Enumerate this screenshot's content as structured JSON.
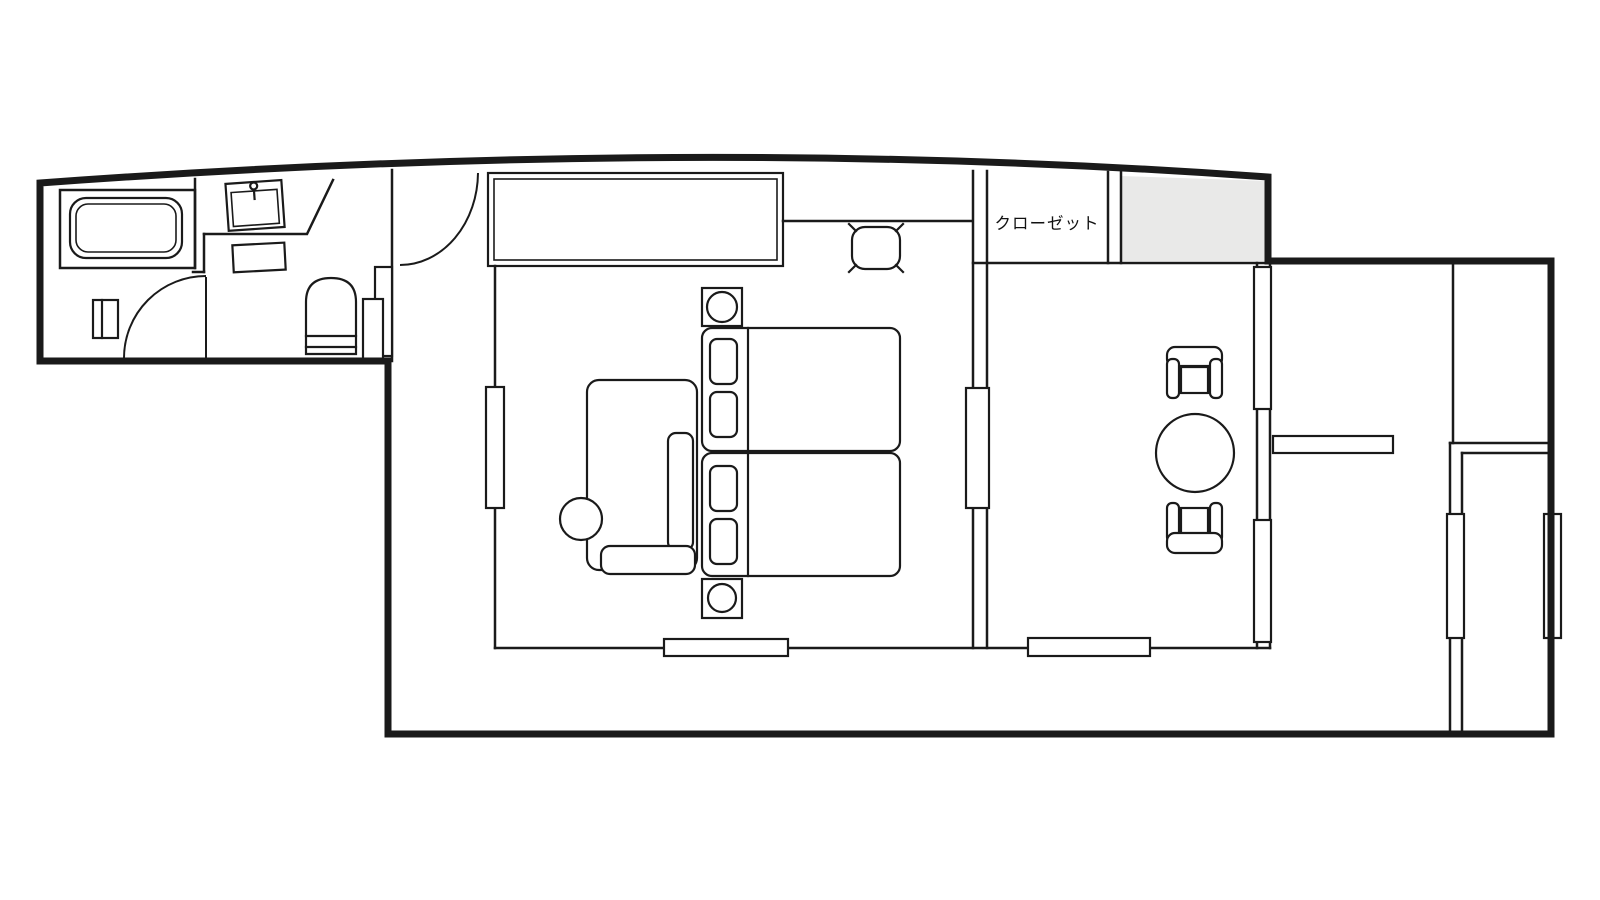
{
  "labels": {
    "closet": "クローゼット"
  },
  "colors": {
    "line": "#1a1a1a",
    "background": "#ffffff",
    "shaft_fill": "#e9e9e8"
  },
  "elements": [
    "bathtub-icon",
    "washbasin-icon",
    "vanity-shelf-icon",
    "laundry-space-icon",
    "toilet-icon",
    "washroom-swing-door-icon",
    "hall-sliding-door-icon",
    "entrance-swing-door-icon",
    "wardrobe-icon",
    "window-icon",
    "bed-icon",
    "pillow-icon",
    "nightstand-lamp-icon",
    "floor-cushion-icon",
    "sofa-icon",
    "side-table-icon",
    "fusuma-sliding-door-icon",
    "closet-room",
    "shaft-area",
    "round-table-icon",
    "armchair-icon",
    "counter-shelf-icon",
    "storage-room",
    "veranda-corridor"
  ]
}
